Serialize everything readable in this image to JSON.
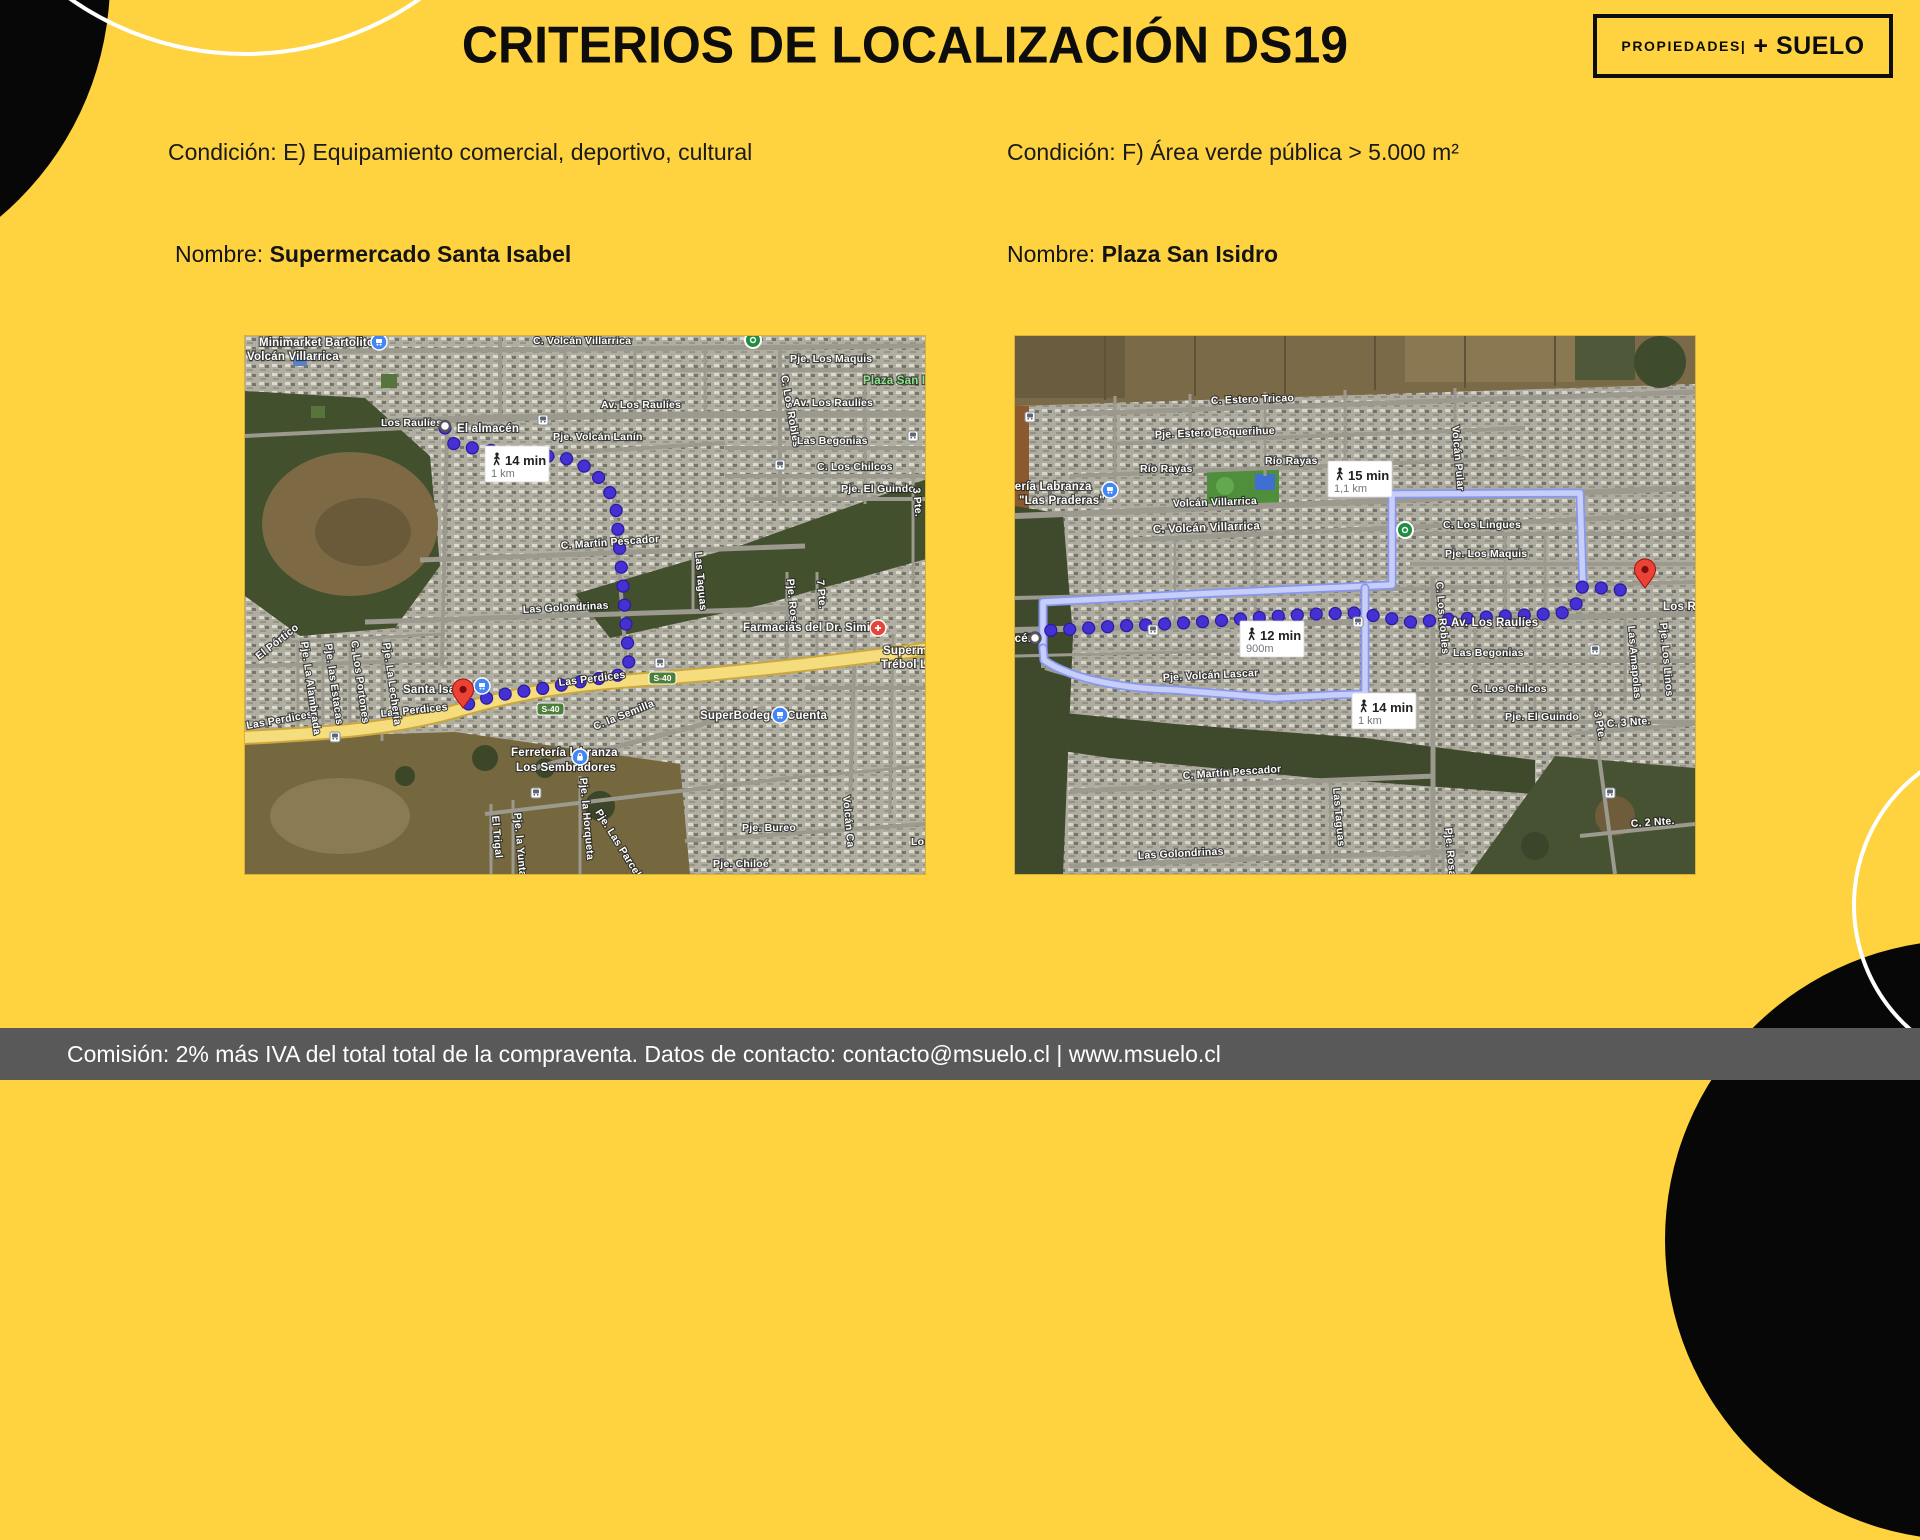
{
  "page": {
    "title": "CRITERIOS DE LOCALIZACIÓN DS19",
    "logo": {
      "small": "PROPIEDADES|",
      "big": "+ SUELO"
    },
    "footer": "Comisión: 2% más IVA del total total de la compraventa. Datos de contacto: contacto@msuelo.cl | www.msuelo.cl",
    "colors": {
      "background": "#FFD23F",
      "footer_bg": "#595959",
      "ink": "#0d0d0d",
      "route_dot": "#4530D4",
      "route_dot_ring": "#2A1B9E",
      "alt_route_outer": "#8898EC",
      "alt_route_inner": "#C7CEF9",
      "road_yellow": "#F5DD7E"
    }
  },
  "columns": [
    {
      "condition": "Condición: E) Equipamiento comercial, deportivo, cultural",
      "name_label": "Nombre: ",
      "name_value": "Supermercado Santa Isabel",
      "map": {
        "badges": [
          {
            "x": 240,
            "y": 110,
            "time": "14 min",
            "dist": "1 km"
          }
        ],
        "shields": [
          {
            "x": 292,
            "y": 367,
            "label": "S-40"
          },
          {
            "x": 404,
            "y": 336,
            "label": "S-40"
          }
        ],
        "route": [
          [
            200,
            92
          ],
          [
            206,
            107
          ],
          [
            232,
            113
          ],
          [
            320,
            122
          ],
          [
            346,
            133
          ],
          [
            363,
            152
          ],
          [
            371,
            172
          ],
          [
            378,
            250
          ],
          [
            382,
            300
          ],
          [
            384,
            330
          ],
          [
            374,
            339
          ],
          [
            300,
            352
          ],
          [
            248,
            360
          ],
          [
            214,
            371
          ]
        ],
        "alt_routes": [],
        "markers": [
          {
            "type": "blue",
            "x": 134,
            "y": 6
          },
          {
            "type": "green",
            "x": 508,
            "y": 4
          },
          {
            "type": "origin",
            "x": 200,
            "y": 90
          },
          {
            "type": "transit",
            "x": 298,
            "y": 84
          },
          {
            "type": "transit",
            "x": 535,
            "y": 129
          },
          {
            "type": "transit",
            "x": 668,
            "y": 100
          },
          {
            "type": "transit",
            "x": 415,
            "y": 327
          },
          {
            "type": "transit",
            "x": 90,
            "y": 401
          },
          {
            "type": "transit",
            "x": 291,
            "y": 457
          },
          {
            "type": "redshop",
            "x": 633,
            "y": 292
          },
          {
            "type": "blue",
            "x": 237,
            "y": 350
          },
          {
            "type": "blue",
            "x": 535,
            "y": 379
          },
          {
            "type": "lock",
            "x": 335,
            "y": 421
          },
          {
            "type": "pin",
            "x": 218,
            "y": 372
          }
        ],
        "labels": [
          {
            "t": "Minimarket Bartolito",
            "x": 14,
            "y": 10,
            "b": 1
          },
          {
            "t": "Volcán Villarrica",
            "x": 2,
            "y": 24,
            "b": 1
          },
          {
            "t": "C. Volcán Villarrica",
            "x": 288,
            "y": 8
          },
          {
            "t": "Pje. Los Maquis",
            "x": 545,
            "y": 26
          },
          {
            "t": "Plaza San Isidro",
            "x": 618,
            "y": 48,
            "c": "park",
            "b": 1
          },
          {
            "t": "Av. Los Raulíes",
            "x": 356,
            "y": 72
          },
          {
            "t": "Av. Los Raulíes",
            "x": 548,
            "y": 70
          },
          {
            "t": "Los Raulíes",
            "x": 136,
            "y": 90
          },
          {
            "t": "El almacén",
            "x": 212,
            "y": 96,
            "b": 1
          },
          {
            "t": "Pje. Volcán Lanín",
            "x": 308,
            "y": 104
          },
          {
            "t": "C. Los Robles",
            "x": 536,
            "y": 40,
            "r": 80
          },
          {
            "t": "Las Begonias",
            "x": 552,
            "y": 108
          },
          {
            "t": "C. Los Chilcos",
            "x": 572,
            "y": 134
          },
          {
            "t": "Pje. El Guindo",
            "x": 596,
            "y": 156
          },
          {
            "t": "3 Pte.",
            "x": 668,
            "y": 152,
            "r": 85
          },
          {
            "t": "C. Martín Pescador",
            "x": 316,
            "y": 213,
            "r": -4
          },
          {
            "t": "Las Taguas",
            "x": 450,
            "y": 216,
            "r": 85
          },
          {
            "t": "Las Golondrinas",
            "x": 278,
            "y": 277,
            "r": -3
          },
          {
            "t": "Pje. Rosa",
            "x": 542,
            "y": 243,
            "r": 85
          },
          {
            "t": "7 Pte.",
            "x": 572,
            "y": 244,
            "r": 85
          },
          {
            "t": "Farmacias del Dr. Simi",
            "x": 498,
            "y": 295,
            "b": 1
          },
          {
            "t": "Supermercado",
            "x": 638,
            "y": 318,
            "b": 1
          },
          {
            "t": "Trébol Labranza",
            "x": 636,
            "y": 332,
            "b": 1
          },
          {
            "t": "Santa Isabel",
            "x": 158,
            "y": 357,
            "b": 1
          },
          {
            "t": "Las Perdices",
            "x": 136,
            "y": 381,
            "r": -6
          },
          {
            "t": "Las Perdices",
            "x": 314,
            "y": 350,
            "r": -7
          },
          {
            "t": "Las Perdices",
            "x": 2,
            "y": 393,
            "r": -10
          },
          {
            "t": "SuperBodega aCuenta",
            "x": 455,
            "y": 383,
            "b": 1
          },
          {
            "t": "Ferretería labranza",
            "x": 266,
            "y": 420,
            "b": 1
          },
          {
            "t": "Los Sembradores",
            "x": 271,
            "y": 435,
            "b": 1
          },
          {
            "t": "C. la Semilla",
            "x": 350,
            "y": 394,
            "r": -22
          },
          {
            "t": "El Pórtico",
            "x": 14,
            "y": 324,
            "r": -38
          },
          {
            "t": "Pje. La Alambrada",
            "x": 56,
            "y": 306,
            "r": 82
          },
          {
            "t": "Pje. las Estacas",
            "x": 80,
            "y": 308,
            "r": 82
          },
          {
            "t": "C. Los Portones",
            "x": 106,
            "y": 305,
            "r": 82
          },
          {
            "t": "Pje. La Lechería",
            "x": 138,
            "y": 307,
            "r": 82
          },
          {
            "t": "El Trigal",
            "x": 247,
            "y": 480,
            "r": 85
          },
          {
            "t": "Pje. la Yunta",
            "x": 269,
            "y": 477,
            "r": 85
          },
          {
            "t": "Pje. la Horqueta",
            "x": 335,
            "y": 442,
            "r": 85
          },
          {
            "t": "Pje. Las Parcelas",
            "x": 350,
            "y": 476,
            "r": 58
          },
          {
            "t": "Pje. Bureo",
            "x": 497,
            "y": 495
          },
          {
            "t": "Pje. Chiloé",
            "x": 468,
            "y": 531
          },
          {
            "t": "Volcán Ca",
            "x": 598,
            "y": 460,
            "r": 85
          },
          {
            "t": "Los",
            "x": 666,
            "y": 509
          }
        ]
      }
    },
    {
      "condition": "Condición: F) Área verde pública > 5.000 m²",
      "name_label": "Nombre: ",
      "name_value": "Plaza San Isidro",
      "map": {
        "badges": [
          {
            "x": 313,
            "y": 125,
            "time": "15 min",
            "dist": "1,1 km"
          },
          {
            "x": 225,
            "y": 285,
            "time": "12 min",
            "dist": "900m"
          },
          {
            "x": 337,
            "y": 357,
            "time": "14 min",
            "dist": "1 km"
          }
        ],
        "shields": [],
        "route": [
          [
            20,
            302
          ],
          [
            26,
            295
          ],
          [
            60,
            293
          ],
          [
            103,
            290
          ],
          [
            150,
            288
          ],
          [
            200,
            285
          ],
          [
            250,
            281
          ],
          [
            300,
            278
          ],
          [
            340,
            277
          ],
          [
            362,
            280
          ],
          [
            395,
            286
          ],
          [
            440,
            283
          ],
          [
            490,
            280
          ],
          [
            530,
            278
          ],
          [
            557,
            276
          ],
          [
            564,
            262
          ],
          [
            566,
            251
          ],
          [
            587,
            252
          ],
          [
            605,
            254
          ],
          [
            620,
            250
          ]
        ],
        "alt_routes": [
          "M28,312 L28,266 L200,257 L377,249 L377,158 L565,157 L568,252",
          "M28,312 L29,324 C60,346 120,353 160,354 L260,362 L317,359 L350,358 L350,252"
        ],
        "markers": [
          {
            "type": "transit",
            "x": 15,
            "y": 81
          },
          {
            "type": "blue",
            "x": 95,
            "y": 154
          },
          {
            "type": "green",
            "x": 390,
            "y": 194
          },
          {
            "type": "origin",
            "x": 20,
            "y": 302
          },
          {
            "type": "transit",
            "x": 138,
            "y": 294
          },
          {
            "type": "transit",
            "x": 343,
            "y": 286
          },
          {
            "type": "transit",
            "x": 580,
            "y": 314
          },
          {
            "type": "transit",
            "x": 595,
            "y": 457
          },
          {
            "type": "pin",
            "x": 630,
            "y": 252
          }
        ],
        "labels": [
          {
            "t": "C. Estero Tricao",
            "x": 196,
            "y": 68,
            "r": -2
          },
          {
            "t": "Pje. Estero Boquerihue",
            "x": 140,
            "y": 102,
            "r": -2
          },
          {
            "t": "Río Rayas",
            "x": 125,
            "y": 136
          },
          {
            "t": "Río Rayas",
            "x": 250,
            "y": 128
          },
          {
            "t": "Ferretería Labranza",
            "x": -34,
            "y": 154,
            "b": 1
          },
          {
            "t": "\"Las Praderas\"",
            "x": 4,
            "y": 168,
            "b": 1
          },
          {
            "t": "Volcán Villarrica",
            "x": 158,
            "y": 171,
            "r": -2
          },
          {
            "t": "C. Volcán Villarrica",
            "x": 138,
            "y": 197,
            "r": -2,
            "b": 1
          },
          {
            "t": "Volcán Pular",
            "x": 437,
            "y": 90,
            "r": 85
          },
          {
            "t": "C. Los Lingues",
            "x": 428,
            "y": 192
          },
          {
            "t": "Pje. Los Maquis",
            "x": 430,
            "y": 221
          },
          {
            "t": "C. Los Robles",
            "x": 421,
            "y": 246,
            "r": 85
          },
          {
            "t": "Av. Los Raulíes",
            "x": 436,
            "y": 290,
            "b": 1
          },
          {
            "t": "Los Raulíes",
            "x": 648,
            "y": 274,
            "b": 1
          },
          {
            "t": "Las Begonias",
            "x": 438,
            "y": 320
          },
          {
            "t": "C. Los Chilcos",
            "x": 456,
            "y": 356
          },
          {
            "t": "Pje. El Guindo",
            "x": 490,
            "y": 384
          },
          {
            "t": "Las Amapolas",
            "x": 613,
            "y": 290,
            "r": 85
          },
          {
            "t": "Pje. Los Linos",
            "x": 645,
            "y": 287,
            "r": 85
          },
          {
            "t": "3 Pte.",
            "x": 579,
            "y": 376,
            "r": 80
          },
          {
            "t": "C. 3 Nte.",
            "x": 592,
            "y": 391,
            "r": -4
          },
          {
            "t": "C. 2 Nte.",
            "x": 616,
            "y": 491,
            "r": -4
          },
          {
            "t": "El almacén",
            "x": -42,
            "y": 306,
            "b": 1
          },
          {
            "t": "Pje. Volcán Lascar",
            "x": 148,
            "y": 345,
            "r": -3
          },
          {
            "t": "C. Martín Pescador",
            "x": 168,
            "y": 443,
            "r": -4
          },
          {
            "t": "Las Taguas",
            "x": 318,
            "y": 452,
            "r": 85
          },
          {
            "t": "Las Golondrinas",
            "x": 123,
            "y": 523,
            "r": -3
          },
          {
            "t": "Pje. Rosa",
            "x": 430,
            "y": 492,
            "r": 85
          }
        ]
      }
    }
  ]
}
